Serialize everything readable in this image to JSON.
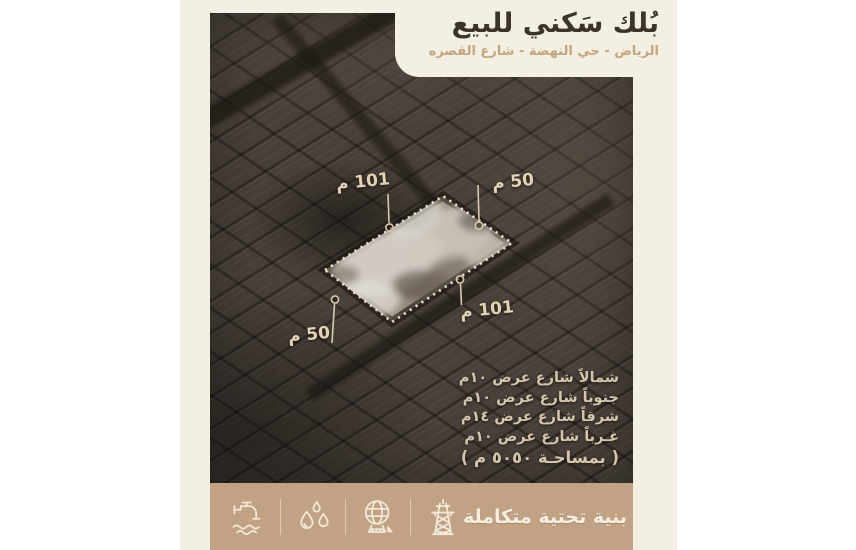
{
  "colors": {
    "page_bg": "#ffffff",
    "panel_bg": "#f4efe3",
    "footer_bar_bg": "#c2a284",
    "title_text": "#3b342a",
    "subtitle_text": "#c3a47d",
    "dimension_label_text": "#e3d3b2",
    "site_info_text": "#d5c6aa",
    "footer_text": "#f6efe1",
    "plot_outline": "#ece1c9"
  },
  "header": {
    "title": "بُلك سَكني للبيع",
    "subtitle": "الرياض - حي النهضة - شارع القصره"
  },
  "map": {
    "labels": {
      "top_length": "101 م",
      "top_width": "50 م",
      "bottom_length": "101 م",
      "bottom_width": "50 م"
    },
    "site_lines": [
      "شمالاً شارع عرض ١٠م",
      "جنوباً شارع عرض ١٠م",
      "شرقاً شارع عرض ١٤م",
      "غـرباً شارع عرض ١٠م",
      "( بمساحـة ٥٠٥٠ م )"
    ]
  },
  "footer": {
    "label": "بنية تحتية متكاملة",
    "icons": [
      "water-tap-icon",
      "water-drops-icon",
      "globe-icon",
      "electricity-tower-icon"
    ]
  }
}
